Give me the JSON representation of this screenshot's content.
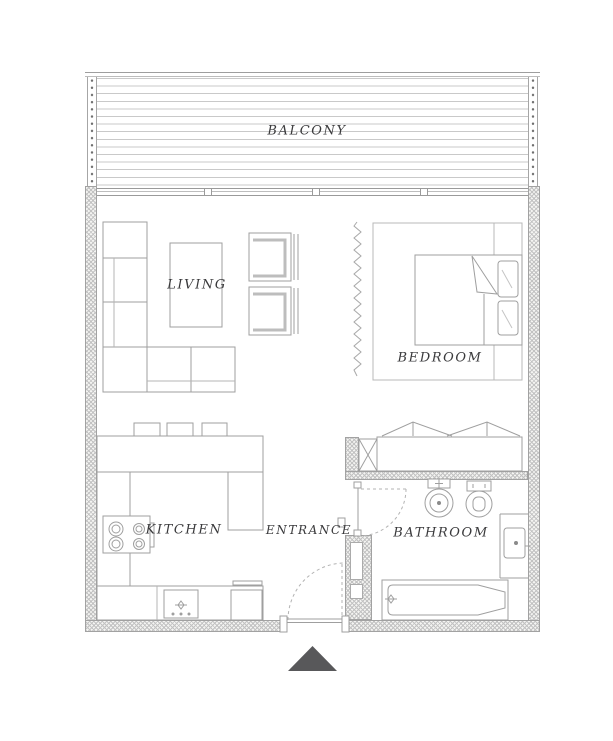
{
  "rooms": {
    "balcony": {
      "label": "BALCONY"
    },
    "living": {
      "label": "LIVING"
    },
    "bedroom": {
      "label": "BEDROOM"
    },
    "kitchen": {
      "label": "KITCHEN"
    },
    "entrance": {
      "label": "ENTRANCE"
    },
    "bathroom": {
      "label": "BATHROOM"
    }
  },
  "icons": {
    "entrance_marker": "triangle-up"
  },
  "colors": {
    "background": "#ffffff",
    "wall_outline": "#a2a2a2",
    "wall_hatch": "#c2c2c2",
    "wall_fill": "#f4f4f2",
    "drawing_line": "#9f9f9f",
    "furniture_accent": "#bdbdbd",
    "label_text": "#3a3a3c",
    "entrance_arrow": "#58585a"
  }
}
